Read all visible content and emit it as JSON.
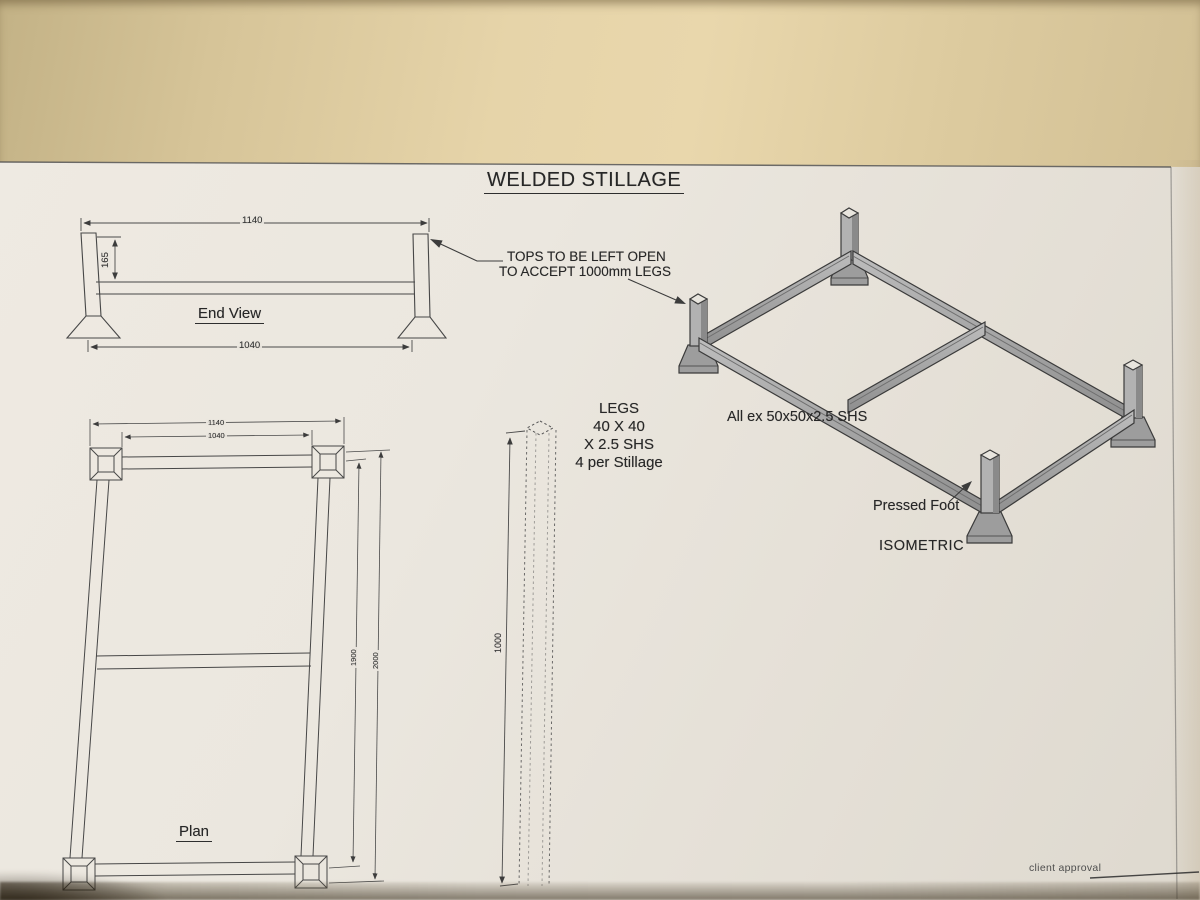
{
  "drawing": {
    "title": "WELDED STILLAGE",
    "note_tops": {
      "line1": "TOPS TO BE LEFT OPEN",
      "line2": "TO ACCEPT 1000mm LEGS"
    },
    "note_legs": {
      "line1": "LEGS",
      "line2": "40 X 40",
      "line3": "X 2.5 SHS",
      "line4": "4 per Stillage"
    },
    "note_material": "All ex 50x50x2.5 SHS",
    "label_pressed_foot": "Pressed Foot",
    "label_isometric": "ISOMETRIC",
    "label_client_approval": "client approval",
    "end_view": {
      "label": "End View",
      "dim_overall_width": "1140",
      "dim_leg_height": "165",
      "dim_foot_span": "1040"
    },
    "plan_view": {
      "label": "Plan",
      "dim_overall_width": "1140",
      "dim_inner_width": "1040",
      "dim_inner_length": "1900",
      "dim_overall_length": "2000"
    },
    "leg_detail": {
      "dim_length": "1000"
    },
    "colors": {
      "paper": "#eae6de",
      "band": "#e6d4a9",
      "ink": "#3e3e3e",
      "steel_gray": "#a8a8a8"
    }
  }
}
